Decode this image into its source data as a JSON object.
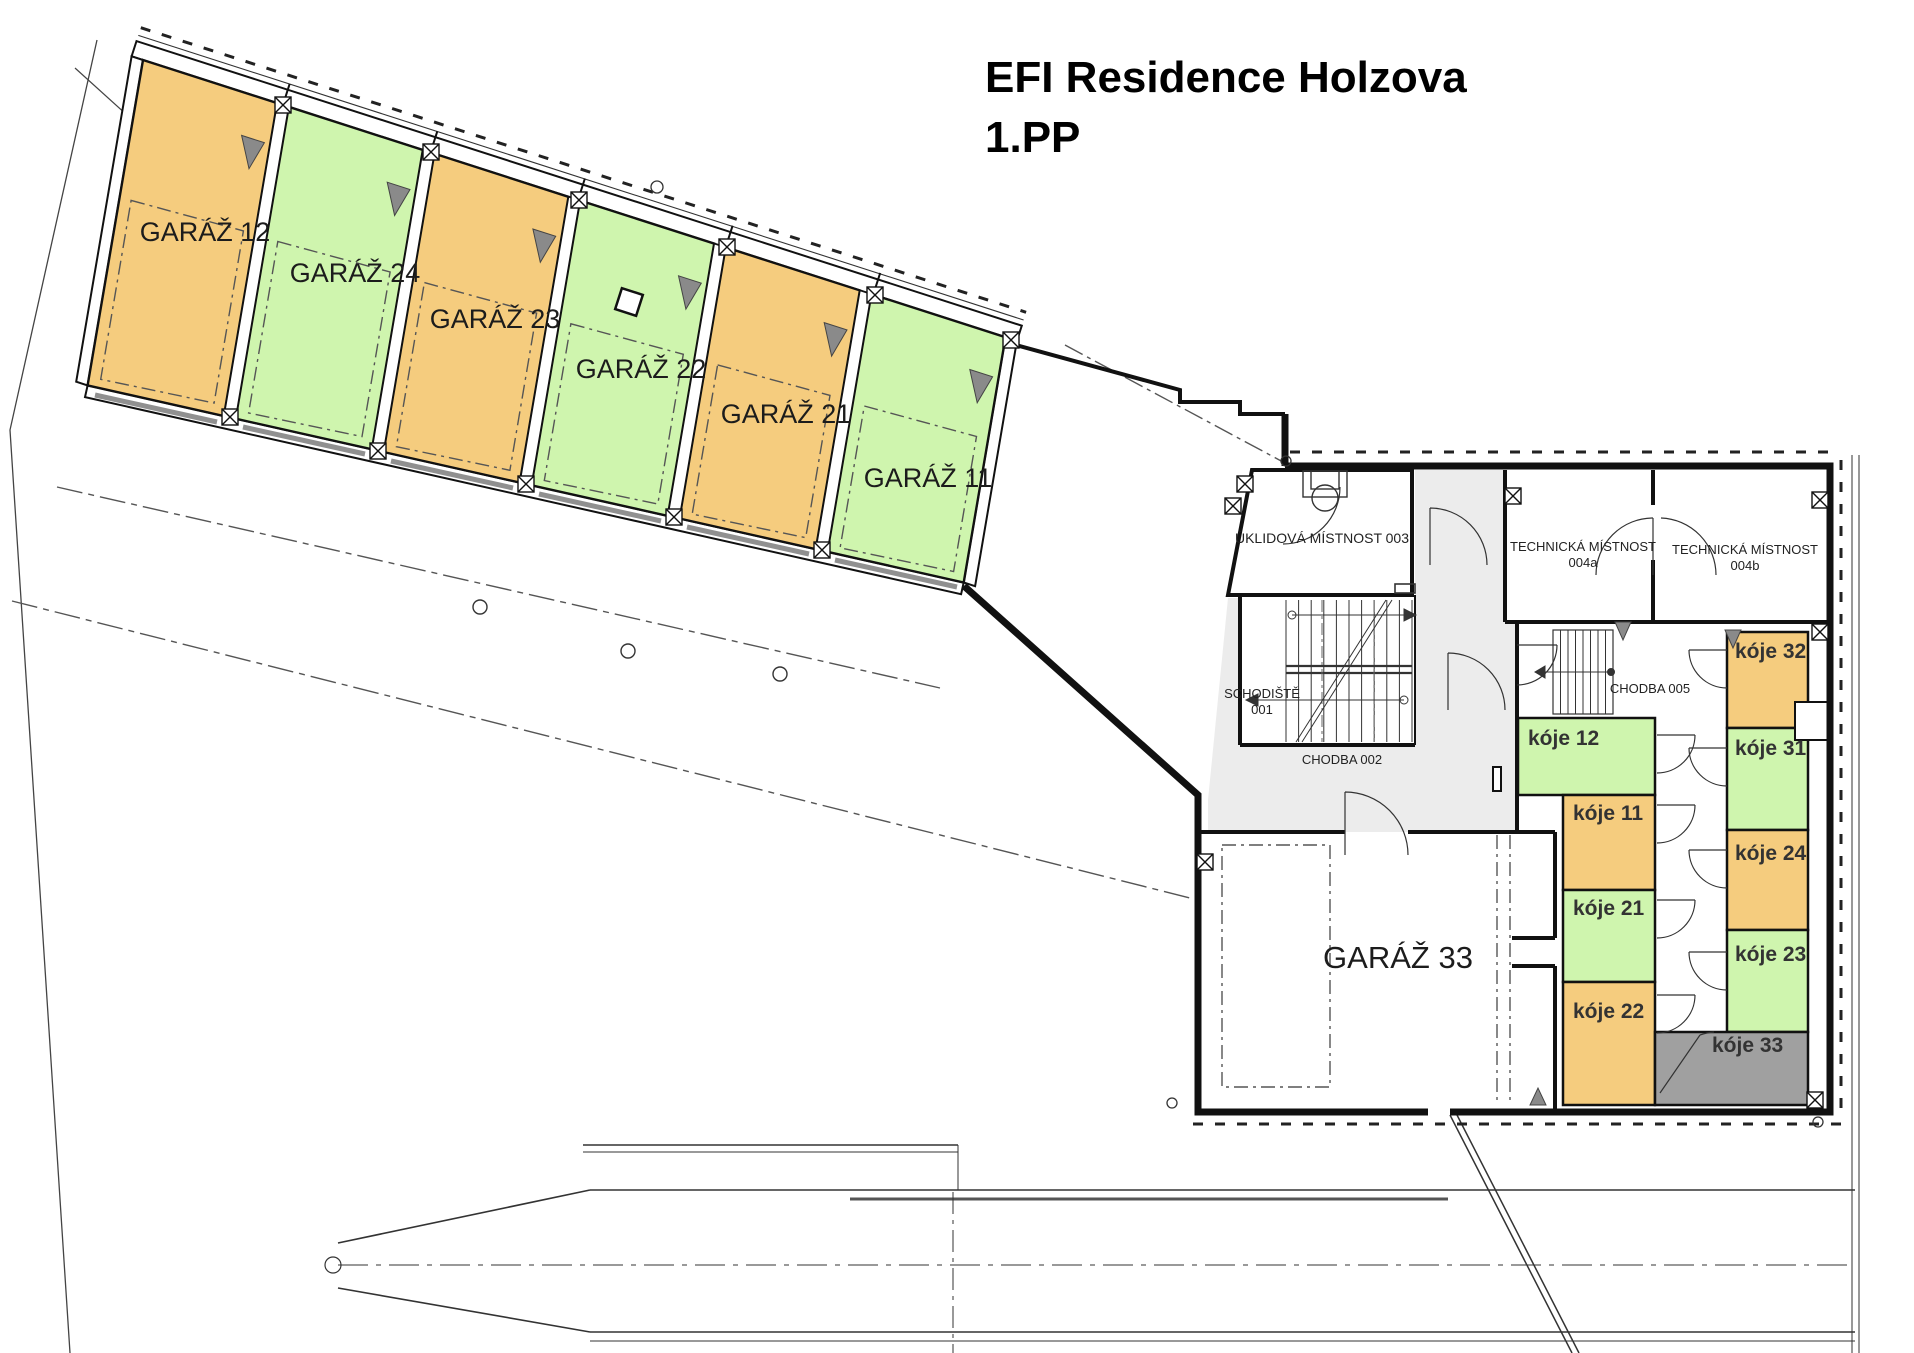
{
  "title": {
    "line1": "EFI Residence Holzova",
    "line2": "1.PP"
  },
  "colors": {
    "orange": "#F5CC7E",
    "green": "#CFF5AE",
    "gray": "#A0A0A0",
    "corridor": "#ECECEC",
    "white": "#FFFFFF",
    "wall": "#1b1b1b",
    "door_gray": "#909090",
    "triangle_gray": "#8a8a8a"
  },
  "garages": [
    {
      "id": "garaz-12",
      "label": "GARÁŽ 12",
      "color_key": "orange"
    },
    {
      "id": "garaz-24",
      "label": "GARÁŽ 24",
      "color_key": "green"
    },
    {
      "id": "garaz-23",
      "label": "GARÁŽ 23",
      "color_key": "orange"
    },
    {
      "id": "garaz-22",
      "label": "GARÁŽ 22",
      "color_key": "green"
    },
    {
      "id": "garaz-21",
      "label": "GARÁŽ 21",
      "color_key": "orange"
    },
    {
      "id": "garaz-11",
      "label": "GARÁŽ 11",
      "color_key": "green"
    },
    {
      "id": "garaz-33",
      "label": "GARÁŽ  33",
      "color_key": "white"
    }
  ],
  "rooms": {
    "uklidova": "ÚKLIDOVÁ MÍSTNOST 003",
    "tech_a_line1": "TECHNICKÁ MÍSTNOST",
    "tech_a_line2": "004a",
    "tech_b_line1": "TECHNICKÁ MÍSTNOST",
    "tech_b_line2": "004b",
    "schodiste_line1": "SCHODIŠTĚ",
    "schodiste_line2": "001",
    "chodba002": "CHODBA 002",
    "chodba005": "CHODBA 005"
  },
  "koje": [
    {
      "id": "koje-12",
      "label": "kóje 12",
      "color_key": "green"
    },
    {
      "id": "koje-11",
      "label": "kóje 11",
      "color_key": "orange"
    },
    {
      "id": "koje-21",
      "label": "kóje 21",
      "color_key": "green"
    },
    {
      "id": "koje-22",
      "label": "kóje 22",
      "color_key": "orange"
    },
    {
      "id": "koje-32",
      "label": "kóje 32",
      "color_key": "orange"
    },
    {
      "id": "koje-31",
      "label": "kóje 31",
      "color_key": "green"
    },
    {
      "id": "koje-24",
      "label": "kóje 24",
      "color_key": "orange"
    },
    {
      "id": "koje-23",
      "label": "kóje 23",
      "color_key": "green"
    },
    {
      "id": "koje-33",
      "label": "kóje 33",
      "color_key": "gray"
    }
  ]
}
